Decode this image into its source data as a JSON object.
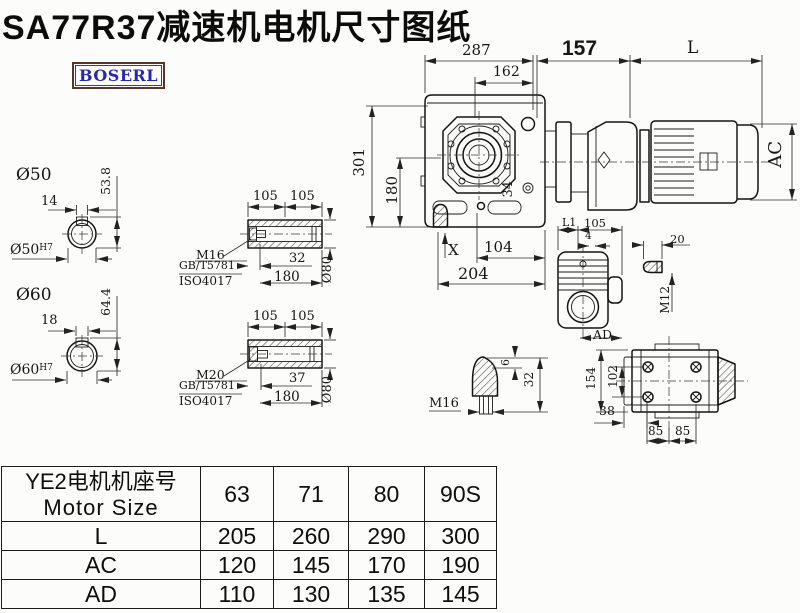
{
  "page": {
    "title": "SA77R37减速机电机尺寸图纸",
    "logo": "BOSERL"
  },
  "colors": {
    "logo_text": "#2828ae",
    "logo_border": "#5a352c",
    "ink": "#141414"
  },
  "drawing": {
    "top_dims": {
      "w287": "287",
      "w162": "162",
      "w157": "157",
      "wL": "L"
    },
    "front": {
      "h301": "301",
      "h180": "180",
      "r34": "34",
      "x_mark": "X",
      "w104": "104",
      "w204": "204"
    },
    "motor": {
      "ac": "AC"
    },
    "shaft50": {
      "title": "Ø50",
      "key": "14",
      "height": "53.8",
      "bore": "Ø50",
      "fit": "H7"
    },
    "shaft60": {
      "title": "Ø60",
      "key": "18",
      "height": "64.4",
      "bore": "Ø60",
      "fit": "H7"
    },
    "sleeve1": {
      "seg1": "105",
      "seg2": "105",
      "bolt": "M16",
      "std1": "GB/T5781",
      "std2": "ISO4017",
      "depth": "32",
      "len": "180",
      "dia": "Ø80"
    },
    "sleeve2": {
      "seg1": "105",
      "seg2": "105",
      "bolt": "M20",
      "std1": "GB/T5781",
      "std2": "ISO4017",
      "depth": "37",
      "len": "180",
      "dia": "Ø80"
    },
    "side": {
      "l1": "L1",
      "w105": "105",
      "w4": "4",
      "ad": "AD"
    },
    "pin": {
      "len": "20",
      "thread": "M12"
    },
    "breather": {
      "thread": "M16",
      "h6": "6",
      "h32": "32"
    },
    "rear": {
      "h154": "154",
      "h102": "102",
      "w38": "38",
      "w85a": "85",
      "w85b": "85"
    }
  },
  "table": {
    "header_cn": "YE2电机机座号",
    "header_en": "Motor Size",
    "columns": [
      "63",
      "71",
      "80",
      "90S"
    ],
    "rows": [
      {
        "label": "L",
        "values": [
          "205",
          "260",
          "290",
          "300"
        ]
      },
      {
        "label": "AC",
        "values": [
          "120",
          "145",
          "170",
          "190"
        ]
      },
      {
        "label": "AD",
        "values": [
          "110",
          "130",
          "135",
          "145"
        ]
      }
    ]
  }
}
